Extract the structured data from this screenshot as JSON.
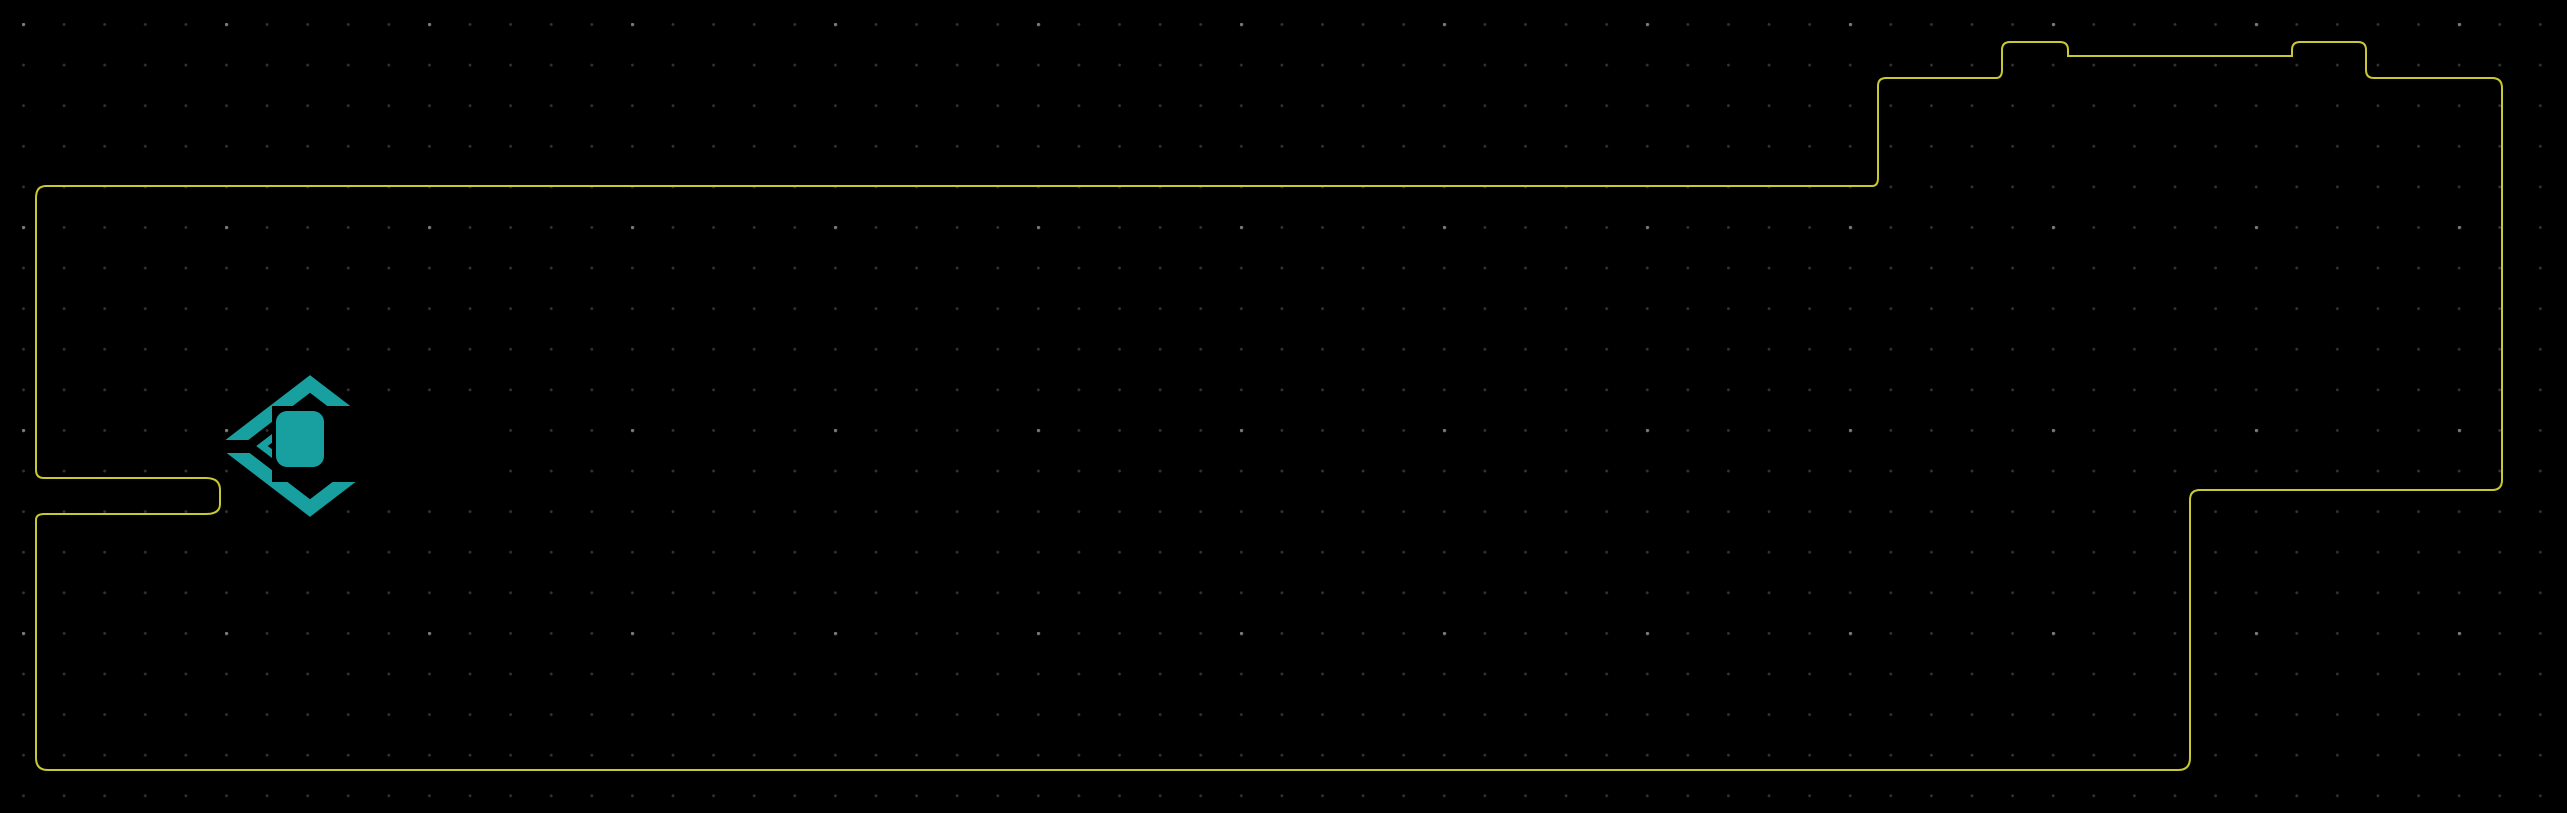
{
  "canvas": {
    "width": 2567,
    "height": 813
  },
  "colors": {
    "background": "#000000",
    "edge_cut": "#c8c832",
    "copper": "#801313",
    "copper_body": "#8f0f0f",
    "copper_stroke": "#cc3434",
    "silkscreen": "#18a0a0",
    "pad_text": "#f2e9df",
    "testpoint": "#cfcf39",
    "via_ring": "#e0d34a",
    "bga_pad": "#70101f",
    "bga_pad_stroke": "#962036",
    "bga_dot": "#c22a52",
    "ddr_pad": "#981820",
    "ddr_pad_stroke": "#b32e36",
    "green_pad": "#1f8c1f",
    "ref_text": "#9a9a9a",
    "fiducial_blue": "#2a35c0",
    "dark_red": "#5a0a0a"
  },
  "refs": {
    "j6": "J6"
  },
  "texts": {
    "hw_version": "HW1.2E",
    "logo_p": "P",
    "logo_ixel": "IXEL",
    "logo_fx": "FX",
    "bga_corner": "A"
  },
  "testpoints": [
    {
      "pin": "1",
      "net": "GND"
    },
    {
      "pin": "1",
      "net": "GND"
    },
    {
      "pin": "1",
      "net": "GND"
    },
    {
      "pin": "1",
      "net": "GND"
    }
  ],
  "shield_pad": {
    "pin": "20",
    "net": "GND"
  },
  "audio": {
    "top_pin": "2",
    "bottom_pin": "1",
    "cols": [
      {
        "letter": "C",
        "name": "SCLK",
        "sub": "mclk relay"
      },
      {
        "letter": "D",
        "name": "LRCK",
        "sub": "mclk pcclk"
      },
      {
        "letter": "E",
        "name": "ADATA",
        "sub": "mclk hdmi"
      },
      {
        "letter": "F",
        "name": "ADATA",
        "sub": "SPDIF"
      }
    ]
  },
  "id_pads": {
    "pin1": "1",
    "pin2": "2",
    "net": "GND",
    "rows": [
      {
        "letter": "G",
        "name": "ID_3"
      },
      {
        "letter": "H",
        "name": "ID_2"
      },
      {
        "letter": "J",
        "name": "ID_1"
      },
      {
        "letter": "K",
        "name": "ID_0"
      }
    ]
  },
  "qfns": {
    "u_main": {
      "pin": "69",
      "net": "GND"
    },
    "u49": {
      "pin": "49",
      "net": "GND"
    },
    "u21": {
      "pin": "21",
      "net": "GND"
    }
  },
  "chips9": {
    "small": "9",
    "big": "9"
  },
  "clk_pad": {
    "pin_top": "2",
    "name": "CLK0",
    "pin_bottom": "1"
  },
  "left_pads": {
    "p33": {
      "pin": "2",
      "net": "3.3V"
    },
    "pgnd": {
      "pin": "1",
      "net": "GND"
    },
    "p12": {
      "pin": "1",
      "net": "1.2V"
    },
    "pgnd2": {
      "pin": "2",
      "net": "GND"
    },
    "jtag": [
      {
        "pin": "1",
        "net": "TDI"
      },
      {
        "pin": "3",
        "net": "TDO"
      },
      {
        "pin": "1",
        "net": "TCK"
      },
      {
        "pin": "3",
        "net": "TMS"
      }
    ],
    "gnd_vias": {
      "net": "GND"
    }
  },
  "vregs": [
    {
      "pin_l": "1",
      "net_l": "GND",
      "pin_r": "2",
      "net_r": "AVCC"
    },
    {
      "pin_l": "1",
      "net_l": "1.2V",
      "pin_r": "2",
      "net_r": "AVCC"
    },
    {
      "pin_l": "2",
      "net_l": "1.2V",
      "pin_r": "1",
      "net_r": "DVCC"
    },
    {
      "pin_l": "1",
      "net_l": "GND",
      "pin_r": "2",
      "net_r": "GVCC"
    }
  ],
  "quads": {
    "a": [
      {
        "pin": "4",
        "net": "GND"
      },
      {
        "pin": "3",
        "net": ""
      },
      {
        "pin": "1",
        "net": ""
      },
      {
        "pin": "2",
        "net": "GND"
      }
    ],
    "b": [
      {
        "pin": "2",
        "net": "GND"
      },
      {
        "pin": "1",
        "net": ""
      },
      {
        "pin": "3",
        "net": ""
      },
      {
        "pin": "4",
        "net": "GND"
      }
    ]
  },
  "rescue": {
    "pin": "1",
    "net": "rescue",
    "marker": "1"
  },
  "rts": {
    "pin": "1",
    "net": "RTS"
  },
  "corner_comp": {
    "left": {
      "pin": "2",
      "net": "GND"
    },
    "right": {
      "pin": "2",
      "net": "GND"
    },
    "round_gnd": {
      "pin": "2",
      "net": "GND"
    },
    "bottom": {
      "pin": "1",
      "net": ""
    }
  },
  "usb_aux": {
    "gnd": {
      "pin": "1",
      "net": "GND"
    },
    "p5": {
      "pin": "5",
      "net": "+5"
    },
    "p2": {
      "pin": "2",
      "net": "+5"
    }
  }
}
